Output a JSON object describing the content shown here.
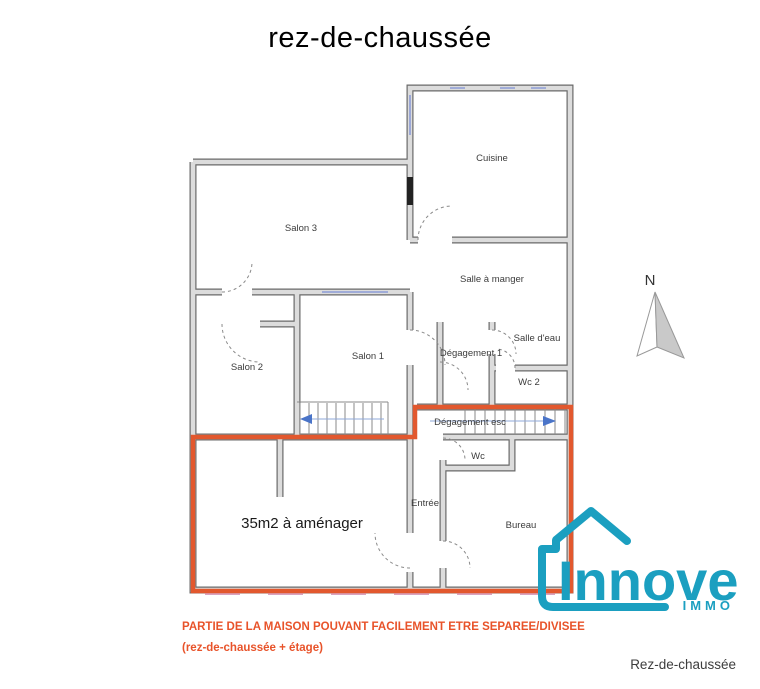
{
  "title": "rez-de-chaussée",
  "plan": {
    "north_label": "N",
    "rooms": [
      {
        "id": "cuisine",
        "label": "Cuisine"
      },
      {
        "id": "salon-3",
        "label": "Salon 3"
      },
      {
        "id": "salle-a-manger",
        "label": "Salle à manger"
      },
      {
        "id": "salon-2",
        "label": "Salon 2"
      },
      {
        "id": "salon-1",
        "label": "Salon 1"
      },
      {
        "id": "degagement-1",
        "label": "Dégagement 1"
      },
      {
        "id": "salle-d-eau",
        "label": "Salle d'eau"
      },
      {
        "id": "wc-2",
        "label": "Wc 2"
      },
      {
        "id": "degagement-esc",
        "label": "Dégagement esc"
      },
      {
        "id": "wc",
        "label": "Wc"
      },
      {
        "id": "entree",
        "label": "Entrée"
      },
      {
        "id": "bureau",
        "label": "Bureau"
      },
      {
        "id": "amenager",
        "label": "35m2 à aménager"
      }
    ]
  },
  "colors": {
    "highlight": "#e2582e",
    "brand": "#1b9fc0",
    "caption": "#e8532a",
    "wall_fill": "#dcdcdc",
    "wall_stroke": "#6a6a6a",
    "window_blue": "#8c9cd6",
    "window_pink": "#d9a3bf",
    "stair_arrow": "#4a74c8",
    "north_fill": "#c9c9c9"
  },
  "branding": {
    "name": "Innove",
    "sub": "IMMO"
  },
  "caption": {
    "line1": "PARTIE DE LA MAISON POUVANT FACILEMENT ETRE SEPAREE/DIVISEE",
    "line2": "(rez-de-chaussée + étage)"
  },
  "footer": {
    "label": "Rez-de-chaussée"
  }
}
